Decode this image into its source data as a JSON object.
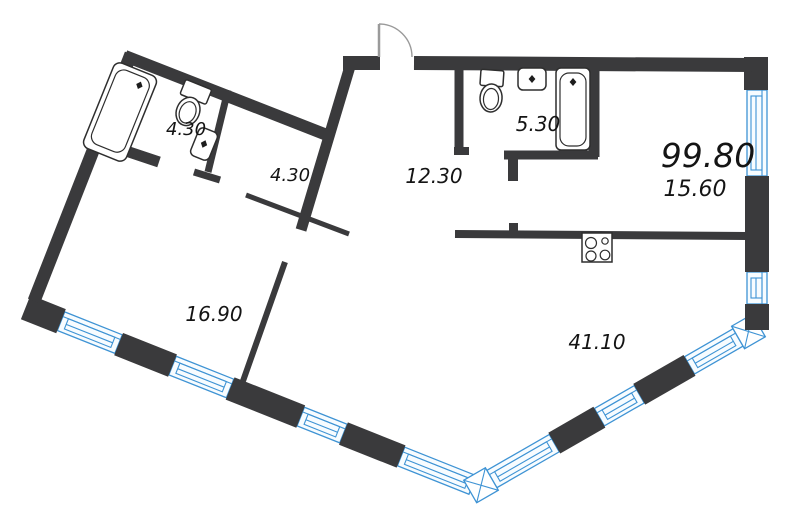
{
  "plan": {
    "type": "apartment-floor-plan",
    "total_area_label": "99.80",
    "rooms": [
      {
        "name": "bathroom-1",
        "area": "4.30"
      },
      {
        "name": "closet",
        "area": "4.30"
      },
      {
        "name": "bathroom-2",
        "area": "5.30"
      },
      {
        "name": "hallway",
        "area": "12.30"
      },
      {
        "name": "kitchen-area",
        "area": "15.60"
      },
      {
        "name": "bedroom",
        "area": "16.90"
      },
      {
        "name": "living-room",
        "area": "41.10"
      }
    ],
    "fixtures": [
      "bathtub",
      "toilet",
      "sink",
      "bathtub",
      "toilet",
      "sink",
      "stove",
      "entry-door"
    ],
    "colors": {
      "wall": "#3a3a3c",
      "window": "#3e93d4",
      "label": "#141414",
      "background": "#ffffff",
      "door_arc": "#9a9a9a"
    }
  }
}
